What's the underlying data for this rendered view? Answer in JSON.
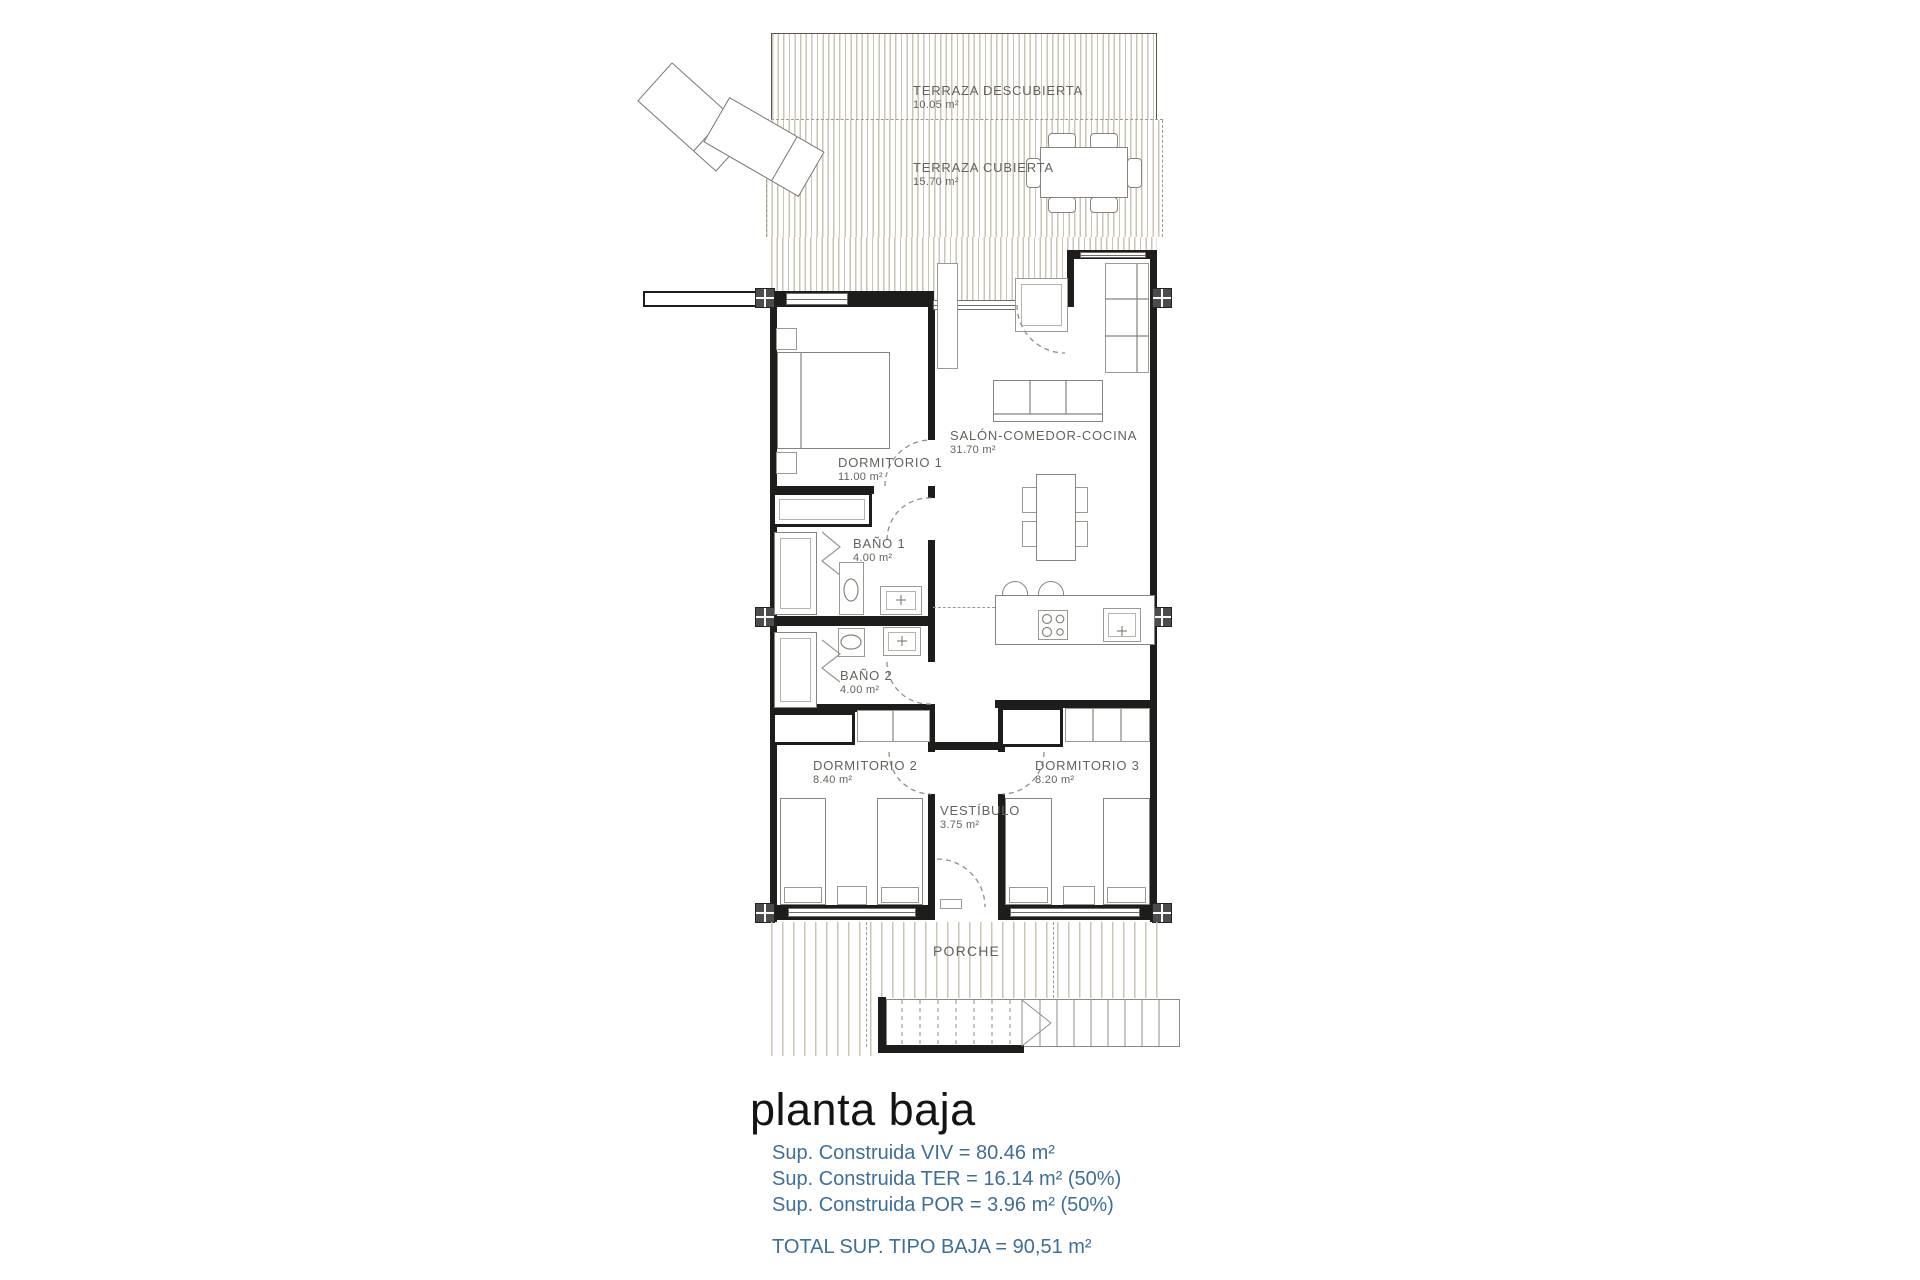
{
  "colors": {
    "wall": "#1d1d1b",
    "terrace_hatch": "#cdc5b4",
    "label_gray": "#63635c",
    "accent_blue": "#3e6e99"
  },
  "rooms": [
    {
      "name": "TERRAZA DESCUBIERTA",
      "area": "10.05 m²"
    },
    {
      "name": "TERRAZA CUBIERTA",
      "area": "15.70 m²"
    },
    {
      "name": "DORMITORIO 1",
      "area": "11.00 m²"
    },
    {
      "name": "SALÓN-COMEDOR-COCINA",
      "area": "31.70 m²"
    },
    {
      "name": "BAÑO 1",
      "area": "4.00 m²"
    },
    {
      "name": "BAÑO 2",
      "area": "4.00 m²"
    },
    {
      "name": "DORMITORIO 2",
      "area": "8.40 m²"
    },
    {
      "name": "DORMITORIO 3",
      "area": "8.20 m²"
    },
    {
      "name": "VESTÍBULO",
      "area": "3.75 m²"
    },
    {
      "name": "PORCHE",
      "area": ""
    }
  ],
  "footer": {
    "title": "planta baja",
    "lines": [
      "Sup. Construida VIV = 80.46 m²",
      "Sup. Construida TER = 16.14 m² (50%)",
      "Sup. Construida POR = 3.96 m² (50%)"
    ],
    "total": "TOTAL SUP. TIPO BAJA = 90,51 m²"
  }
}
